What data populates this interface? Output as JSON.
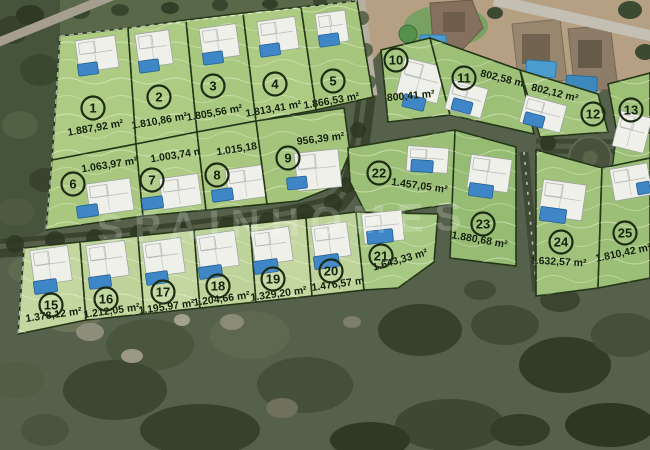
{
  "map": {
    "watermark": "SPAINHOMES",
    "plots": [
      {
        "number": "1",
        "area": "1.887,92 m²",
        "fill": "#aecb84",
        "polygon": [
          [
            60,
            36
          ],
          [
            128,
            28
          ],
          [
            136,
            144
          ],
          [
            52,
            160
          ]
        ],
        "circle": [
          93,
          108
        ],
        "label": [
          96,
          131
        ],
        "label_rotation": -10,
        "house": {
          "rect": [
            77,
            38,
            40,
            32
          ],
          "rot": -8,
          "pool": [
            78,
            63,
            20,
            12
          ]
        }
      },
      {
        "number": "2",
        "area": "1.810,86 m²",
        "fill": "#aecb84",
        "polygon": [
          [
            128,
            28
          ],
          [
            186,
            20
          ],
          [
            197,
            132
          ],
          [
            136,
            144
          ]
        ],
        "circle": [
          159,
          97
        ],
        "label": [
          160,
          124
        ],
        "label_rotation": -10,
        "house": {
          "rect": [
            137,
            32,
            34,
            34
          ],
          "rot": -8,
          "pool": [
            139,
            60,
            20,
            12
          ]
        }
      },
      {
        "number": "3",
        "area": "1.805,56 m²",
        "fill": "#a9c87f",
        "polygon": [
          [
            186,
            20
          ],
          [
            243,
            13
          ],
          [
            256,
            121
          ],
          [
            197,
            132
          ]
        ],
        "circle": [
          213,
          86
        ],
        "label": [
          215,
          116
        ],
        "label_rotation": -10,
        "house": {
          "rect": [
            201,
            26,
            37,
            32
          ],
          "rot": -8,
          "pool": [
            203,
            52,
            20,
            12
          ]
        }
      },
      {
        "number": "4",
        "area": "1.813,41 m²",
        "fill": "#aecb84",
        "polygon": [
          [
            243,
            13
          ],
          [
            301,
            7
          ],
          [
            316,
            110
          ],
          [
            256,
            121
          ]
        ],
        "circle": [
          275,
          84
        ],
        "label": [
          274,
          112
        ],
        "label_rotation": -10,
        "house": {
          "rect": [
            259,
            19,
            38,
            32
          ],
          "rot": -8,
          "pool": [
            260,
            44,
            20,
            12
          ]
        }
      },
      {
        "number": "5",
        "area": "1.866,53 m²",
        "fill": "#a6c67d",
        "polygon": [
          [
            301,
            7
          ],
          [
            357,
            1
          ],
          [
            373,
            97
          ],
          [
            316,
            110
          ]
        ],
        "circle": [
          333,
          81
        ],
        "label": [
          332,
          104
        ],
        "label_rotation": -10,
        "house": {
          "rect": [
            317,
            12,
            30,
            31
          ],
          "rot": -8,
          "pool": [
            319,
            34,
            20,
            12
          ]
        }
      },
      {
        "number": "6",
        "area": "1.063,97 m²",
        "fill": "#a9c77f",
        "polygon": [
          [
            52,
            160
          ],
          [
            136,
            144
          ],
          [
            143,
            216
          ],
          [
            46,
            230
          ]
        ],
        "circle": [
          73,
          184
        ],
        "label": [
          110,
          168
        ],
        "label_rotation": -9,
        "house": {
          "rect": [
            88,
            181,
            44,
            32
          ],
          "rot": -8,
          "pool": [
            77,
            205,
            21,
            12
          ]
        }
      },
      {
        "number": "7",
        "area": "1.003,74 m²",
        "fill": "#afcc86",
        "polygon": [
          [
            136,
            144
          ],
          [
            197,
            132
          ],
          [
            206,
            210
          ],
          [
            143,
            216
          ]
        ],
        "circle": [
          152,
          180
        ],
        "label": [
          179,
          158
        ],
        "label_rotation": -9,
        "house": {
          "rect": [
            161,
            176,
            39,
            31
          ],
          "rot": -8,
          "pool": [
            142,
            197,
            21,
            12
          ]
        }
      },
      {
        "number": "8",
        "area": "1.015,18 m²",
        "fill": "#a9c77f",
        "polygon": [
          [
            197,
            132
          ],
          [
            256,
            121
          ],
          [
            267,
            204
          ],
          [
            206,
            210
          ]
        ],
        "circle": [
          217,
          175
        ],
        "label": [
          245,
          151
        ],
        "label_rotation": -9,
        "house": {
          "rect": [
            227,
            167,
            40,
            32
          ],
          "rot": -8,
          "pool": [
            212,
            189,
            21,
            12
          ]
        }
      },
      {
        "number": "9",
        "area": "956,39 m²",
        "fill": "#a4c47c",
        "polygon": [
          [
            256,
            121
          ],
          [
            344,
            108
          ],
          [
            350,
            152
          ],
          [
            336,
            186
          ],
          [
            298,
            201
          ],
          [
            267,
            204
          ]
        ],
        "circle": [
          288,
          158
        ],
        "label": [
          321,
          142
        ],
        "label_rotation": -7,
        "house": {
          "rect": [
            296,
            151,
            44,
            38
          ],
          "rot": -6,
          "pool": [
            287,
            177,
            20,
            12
          ]
        }
      },
      {
        "number": "10",
        "area": "800,41 m²",
        "fill": "#a3c47d",
        "polygon": [
          [
            381,
            50
          ],
          [
            430,
            38
          ],
          [
            450,
            115
          ],
          [
            388,
            122
          ]
        ],
        "circle": [
          396,
          60
        ],
        "label": [
          411,
          99
        ],
        "label_rotation": -5,
        "house": {
          "rect": [
            400,
            62,
            42,
            37
          ],
          "rot": 14,
          "pool": [
            403,
            96,
            22,
            13
          ]
        }
      },
      {
        "number": "11",
        "area": "802,58 m²",
        "fill": "#9dc077",
        "polygon": [
          [
            430,
            38
          ],
          [
            520,
            70
          ],
          [
            534,
            134
          ],
          [
            450,
            115
          ]
        ],
        "circle": [
          464,
          78
        ],
        "label": [
          503,
          82
        ],
        "label_rotation": 14,
        "house": {
          "rect": [
            448,
            84,
            37,
            30
          ],
          "rot": 15,
          "pool": [
            452,
            100,
            20,
            12
          ]
        }
      },
      {
        "number": "12",
        "area": "802,12 m²",
        "fill": "#a3c47d",
        "polygon": [
          [
            520,
            70
          ],
          [
            598,
            94
          ],
          [
            608,
            132
          ],
          [
            540,
            137
          ]
        ],
        "circle": [
          593,
          114
        ],
        "label": [
          554,
          96
        ],
        "label_rotation": 14,
        "house": {
          "rect": [
            522,
            100,
            42,
            28
          ],
          "rot": 15,
          "pool": [
            524,
            114,
            20,
            12
          ]
        }
      },
      {
        "number": "13",
        "area": "",
        "fill": "#9dc077",
        "polygon": [
          [
            608,
            84
          ],
          [
            650,
            73
          ],
          [
            650,
            130
          ],
          [
            616,
            128
          ]
        ],
        "circle": [
          631,
          110
        ],
        "label": [
          631,
          124
        ],
        "label_rotation": 0,
        "house": {
          "rect": [
            616,
            114,
            32,
            36
          ],
          "rot": 14,
          "pool": [
            631,
            169,
            19,
            12
          ]
        }
      },
      {
        "number": "22",
        "area": "1.457,05 m²",
        "fill": "#9cbf77",
        "polygon": [
          [
            348,
            148
          ],
          [
            455,
            130
          ],
          [
            461,
            203
          ],
          [
            425,
            208
          ],
          [
            368,
            218
          ],
          [
            350,
            182
          ]
        ],
        "circle": [
          379,
          173
        ],
        "label": [
          419,
          189
        ],
        "label_rotation": 8,
        "house": {
          "rect": [
            407,
            147,
            41,
            25
          ],
          "rot": 4,
          "pool": [
            411,
            160,
            22,
            12
          ]
        }
      },
      {
        "number": "23",
        "area": "1.880,68 m²",
        "fill": "#96bb72",
        "polygon": [
          [
            455,
            130
          ],
          [
            516,
            147
          ],
          [
            516,
            266
          ],
          [
            450,
            258
          ]
        ],
        "circle": [
          483,
          224
        ],
        "label": [
          479,
          243
        ],
        "label_rotation": 10,
        "house": {
          "rect": [
            469,
            157,
            41,
            33
          ],
          "rot": 8,
          "pool": [
            469,
            184,
            24,
            13
          ]
        }
      },
      {
        "number": "24",
        "area": "1.632,57 m²",
        "fill": "#a0c27b",
        "polygon": [
          [
            536,
            150
          ],
          [
            602,
            168
          ],
          [
            598,
            288
          ],
          [
            536,
            296
          ]
        ],
        "circle": [
          561,
          242
        ],
        "label": [
          558,
          265
        ],
        "label_rotation": 3,
        "house": {
          "rect": [
            541,
            182,
            43,
            36
          ],
          "rot": 8,
          "pool": [
            540,
            208,
            26,
            14
          ]
        }
      },
      {
        "number": "25",
        "area": "1.810,42 m²",
        "fill": "#9cbf77",
        "polygon": [
          [
            602,
            168
          ],
          [
            650,
            158
          ],
          [
            650,
            278
          ],
          [
            598,
            288
          ]
        ],
        "circle": [
          625,
          233
        ],
        "label": [
          624,
          256
        ],
        "label_rotation": -12,
        "house": {
          "rect": [
            612,
            166,
            38,
            32
          ],
          "rot": -10,
          "pool": [
            637,
            182,
            13,
            12
          ]
        }
      },
      {
        "number": "15",
        "area": "1.378,12 m²",
        "fill": "#c4d7a0",
        "polygon": [
          [
            24,
            248
          ],
          [
            80,
            242
          ],
          [
            86,
            320
          ],
          [
            18,
            334
          ]
        ],
        "circle": [
          51,
          305
        ],
        "label": [
          54,
          318
        ],
        "label_rotation": -8,
        "house": {
          "rect": [
            32,
            248,
            38,
            35
          ],
          "rot": -8,
          "pool": [
            34,
            280,
            23,
            13
          ]
        }
      },
      {
        "number": "16",
        "area": "1.212,05 m²",
        "fill": "#bed39a",
        "polygon": [
          [
            80,
            242
          ],
          [
            138,
            236
          ],
          [
            144,
            314
          ],
          [
            86,
            320
          ]
        ],
        "circle": [
          106,
          299
        ],
        "label": [
          112,
          314
        ],
        "label_rotation": -8,
        "house": {
          "rect": [
            88,
            243,
            39,
            35
          ],
          "rot": -8,
          "pool": [
            89,
            276,
            22,
            12
          ]
        }
      },
      {
        "number": "17",
        "area": "1.195,97 m²",
        "fill": "#c4d7a0",
        "polygon": [
          [
            138,
            236
          ],
          [
            194,
            230
          ],
          [
            200,
            308
          ],
          [
            144,
            314
          ]
        ],
        "circle": [
          163,
          292
        ],
        "label": [
          167,
          310
        ],
        "label_rotation": -8,
        "house": {
          "rect": [
            144,
            240,
            39,
            35
          ],
          "rot": -8,
          "pool": [
            146,
            272,
            22,
            12
          ]
        }
      },
      {
        "number": "18",
        "area": "1.204,66 m²",
        "fill": "#bed39a",
        "polygon": [
          [
            194,
            230
          ],
          [
            250,
            224
          ],
          [
            256,
            302
          ],
          [
            200,
            308
          ]
        ],
        "circle": [
          218,
          286
        ],
        "label": [
          222,
          302
        ],
        "label_rotation": -8,
        "house": {
          "rect": [
            198,
            233,
            39,
            35
          ],
          "rot": -8,
          "pool": [
            199,
            266,
            23,
            12
          ]
        }
      },
      {
        "number": "19",
        "area": "1.329,20 m²",
        "fill": "#c4d7a0",
        "polygon": [
          [
            250,
            224
          ],
          [
            306,
            218
          ],
          [
            312,
            296
          ],
          [
            256,
            302
          ]
        ],
        "circle": [
          273,
          279
        ],
        "label": [
          279,
          297
        ],
        "label_rotation": -8,
        "house": {
          "rect": [
            253,
            229,
            38,
            34
          ],
          "rot": -8,
          "pool": [
            254,
            260,
            24,
            13
          ]
        }
      },
      {
        "number": "20",
        "area": "1.476,57 m²",
        "fill": "#bed39a",
        "polygon": [
          [
            306,
            218
          ],
          [
            356,
            212
          ],
          [
            364,
            290
          ],
          [
            312,
            296
          ]
        ],
        "circle": [
          331,
          271
        ],
        "label": [
          340,
          287
        ],
        "label_rotation": -8,
        "house": {
          "rect": [
            313,
            224,
            36,
            34
          ],
          "rot": -8,
          "pool": [
            314,
            255,
            25,
            13
          ]
        }
      },
      {
        "number": "21",
        "area": "1.643,33 m²",
        "fill": "#a8c983",
        "polygon": [
          [
            356,
            212
          ],
          [
            438,
            214
          ],
          [
            434,
            262
          ],
          [
            398,
            288
          ],
          [
            364,
            290
          ]
        ],
        "circle": [
          381,
          256
        ],
        "label": [
          401,
          263
        ],
        "label_rotation": -16,
        "house": {
          "rect": [
            363,
            212,
            40,
            30
          ],
          "rot": -6,
          "pool": [
            367,
            230,
            26,
            13
          ]
        }
      }
    ]
  }
}
